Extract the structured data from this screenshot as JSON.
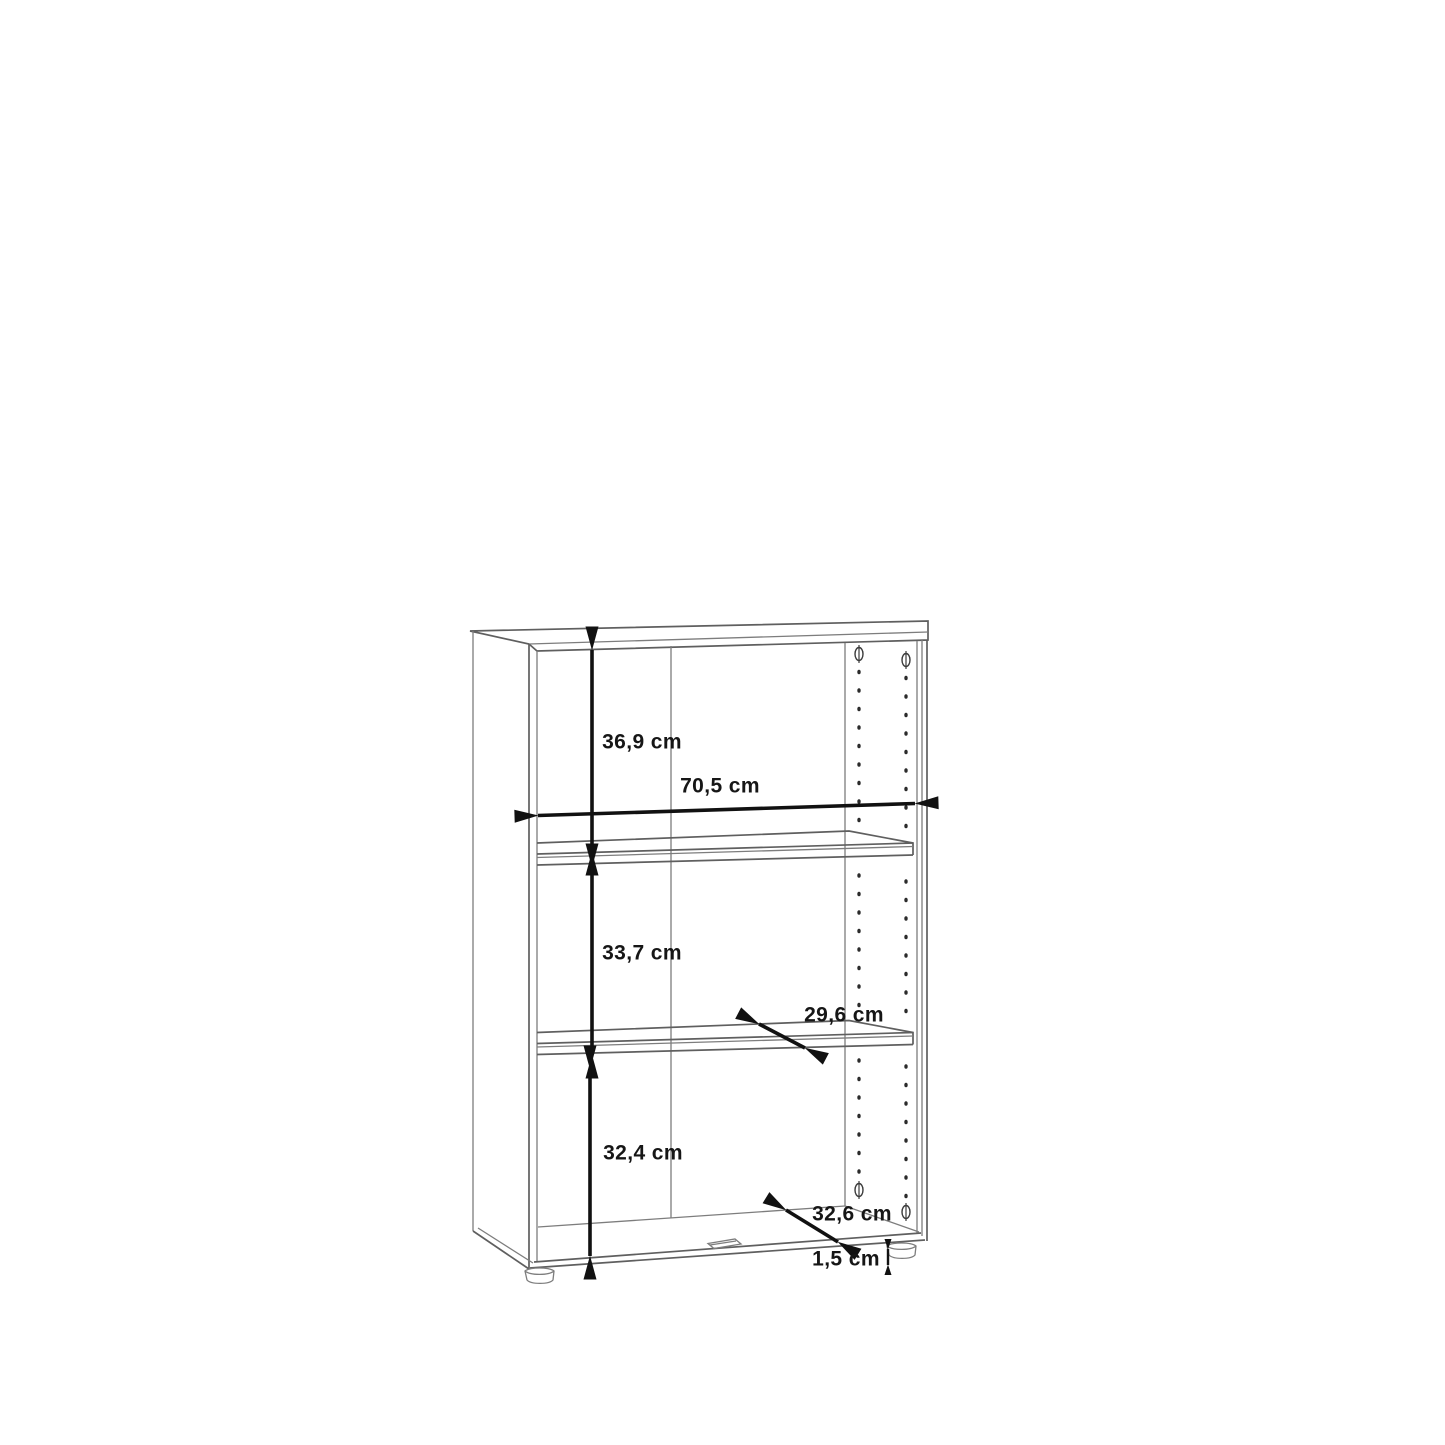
{
  "canvas": {
    "width": 1445,
    "height": 1445,
    "background": "#ffffff"
  },
  "diagram": {
    "type": "furniture dimension line drawing",
    "subject": "open bookcase with two shelves, shelf-pin hole rows, bottom grip notch and adjustable feet",
    "unit": "cm",
    "labels": {
      "top_section_height": "36,9 cm",
      "inner_width": "70,5 cm",
      "middle_section_height": "33,7 cm",
      "shelf_depth": "29,6 cm",
      "bottom_section_height": "32,4 cm",
      "base_depth": "32,6 cm",
      "foot_height": "1,5 cm"
    },
    "colors": {
      "outline_thin": "#7d7d7d",
      "outline_strong": "#5f5f5f",
      "dimension": "#111111",
      "label_text": "#161616",
      "background": "#ffffff"
    }
  }
}
